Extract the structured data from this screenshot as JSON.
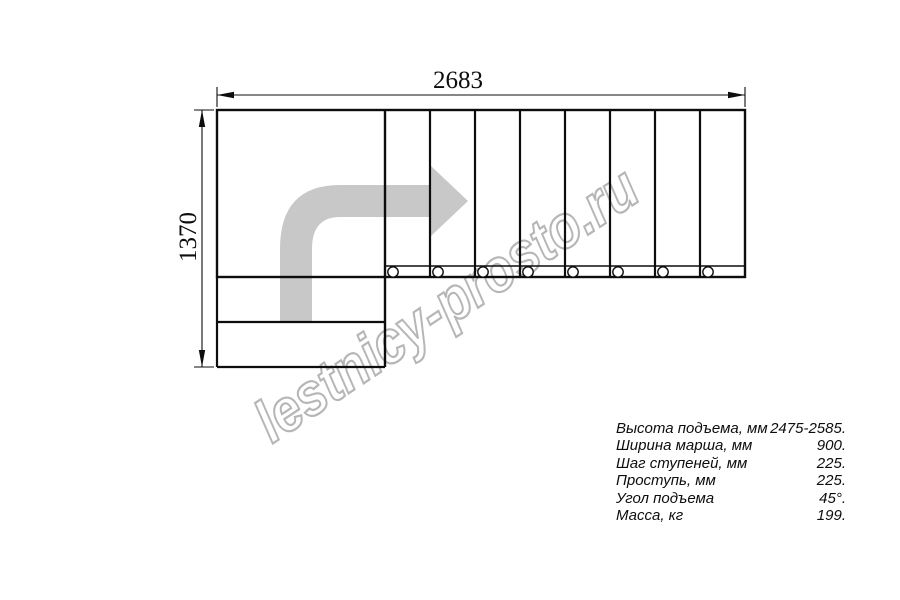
{
  "drawing": {
    "type": "staircase-plan-top-view",
    "width_dim_label": "2683",
    "height_dim_label": "1370",
    "tread_count": 8,
    "entry_step_count": 2,
    "hole_count": 8,
    "direction_arrow": "up-then-right"
  },
  "watermark": {
    "text": "lestnicy-prosto.ru"
  },
  "specs": {
    "rows": [
      {
        "label": "Высота подъема, мм",
        "value": "2475-2585."
      },
      {
        "label": "Ширина марша, мм",
        "value": "900."
      },
      {
        "label": "Шаг ступеней, мм",
        "value": "225."
      },
      {
        "label": "Проступь, мм",
        "value": "225."
      },
      {
        "label": "Угол подъема",
        "value": "45°."
      },
      {
        "label": "Масса, кг",
        "value": "199."
      }
    ]
  },
  "colors": {
    "line": "#0d0d0d",
    "arrow_fill": "#c8c8c8",
    "watermark_stroke": "#b6b6b6",
    "text": "#0d0d0d",
    "background": "#ffffff"
  }
}
